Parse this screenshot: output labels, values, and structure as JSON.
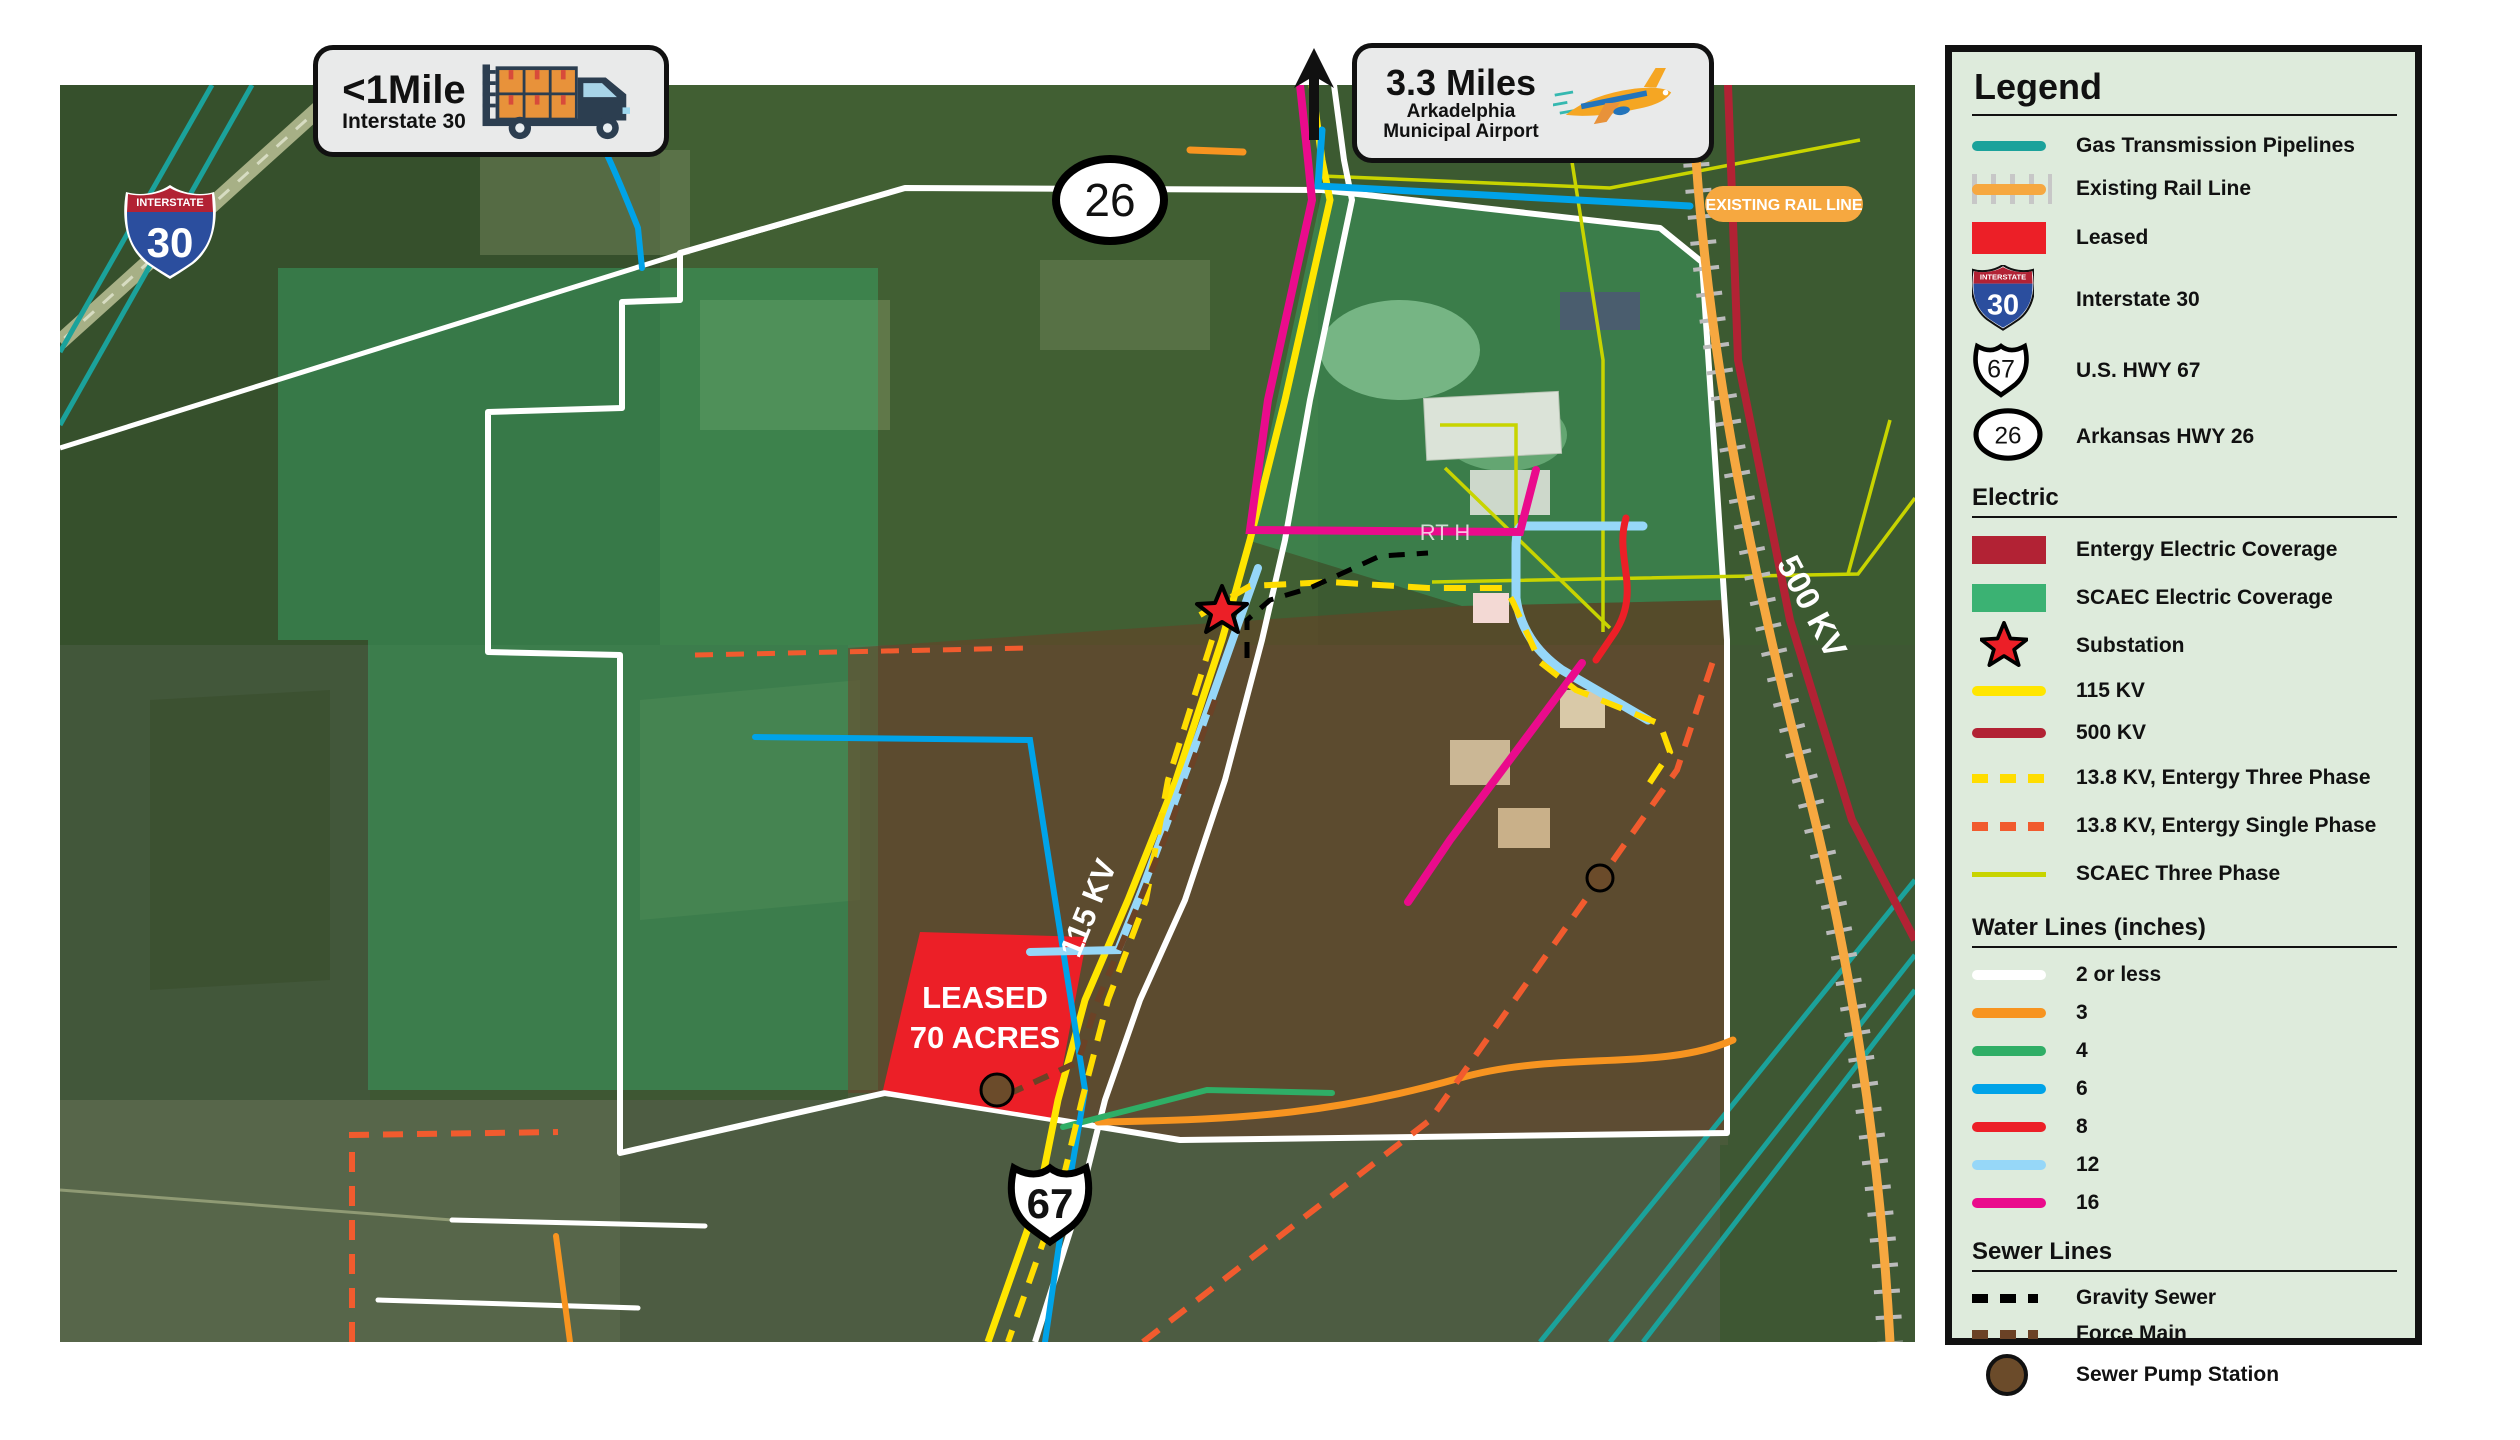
{
  "callouts": {
    "truck": {
      "distance": "<1Mile",
      "subtitle": "Interstate 30"
    },
    "airport": {
      "distance": "3.3 Miles",
      "line1": "Arkadelphia",
      "line2": "Municipal Airport"
    }
  },
  "shields": {
    "interstate_word": "INTERSTATE",
    "i30": "30",
    "us67": "67",
    "ar26": "26"
  },
  "map_labels": {
    "leased_line1": "LEASED",
    "leased_line2": "70 ACRES",
    "kv115": "115 KV",
    "kv500": "500 KV",
    "rail_tag": "EXISTING RAIL LINE",
    "road_tag": "RT H"
  },
  "legend": {
    "title": "Legend",
    "general": [
      {
        "label": "Gas Transmission Pipelines",
        "color": "#1BA29B"
      },
      {
        "label": "Existing Rail Line",
        "color": "#F6A840"
      },
      {
        "label": "Leased",
        "color": "#EC1F27"
      },
      {
        "label": "Interstate 30"
      },
      {
        "label": "U.S. HWY 67"
      },
      {
        "label": "Arkansas HWY 26"
      }
    ],
    "electric": {
      "header": "Electric",
      "items": [
        {
          "label": "Entergy Electric Coverage",
          "color": "#B22234"
        },
        {
          "label": "SCAEC Electric Coverage",
          "color": "#3BB273"
        },
        {
          "label": "Substation",
          "color": "#EC1F27"
        },
        {
          "label": "115 KV",
          "color": "#FFE600"
        },
        {
          "label": "500 KV",
          "color": "#B22234"
        },
        {
          "label": "13.8 KV, Entergy Three Phase",
          "color": "#FFDD00"
        },
        {
          "label": "13.8 KV, Entergy Single Phase",
          "color": "#F15B2E"
        },
        {
          "label": "SCAEC Three Phase",
          "color": "#C8D400"
        }
      ]
    },
    "water": {
      "header": "Water Lines (inches)",
      "items": [
        {
          "label": "2 or less",
          "color": "#FFFFFF"
        },
        {
          "label": "3",
          "color": "#F79420"
        },
        {
          "label": "4",
          "color": "#2FAE66"
        },
        {
          "label": "6",
          "color": "#00A3E8"
        },
        {
          "label": "8",
          "color": "#EC1F27"
        },
        {
          "label": "12",
          "color": "#96D7F8"
        },
        {
          "label": "16",
          "color": "#EA0B8C"
        }
      ]
    },
    "sewer": {
      "header": "Sewer Lines",
      "items": [
        {
          "label": "Gravity Sewer",
          "color": "#000000"
        },
        {
          "label": "Force Main",
          "color": "#6B4226"
        },
        {
          "label": "Sewer Pump Station",
          "color": "#6B4B2A"
        }
      ]
    }
  }
}
